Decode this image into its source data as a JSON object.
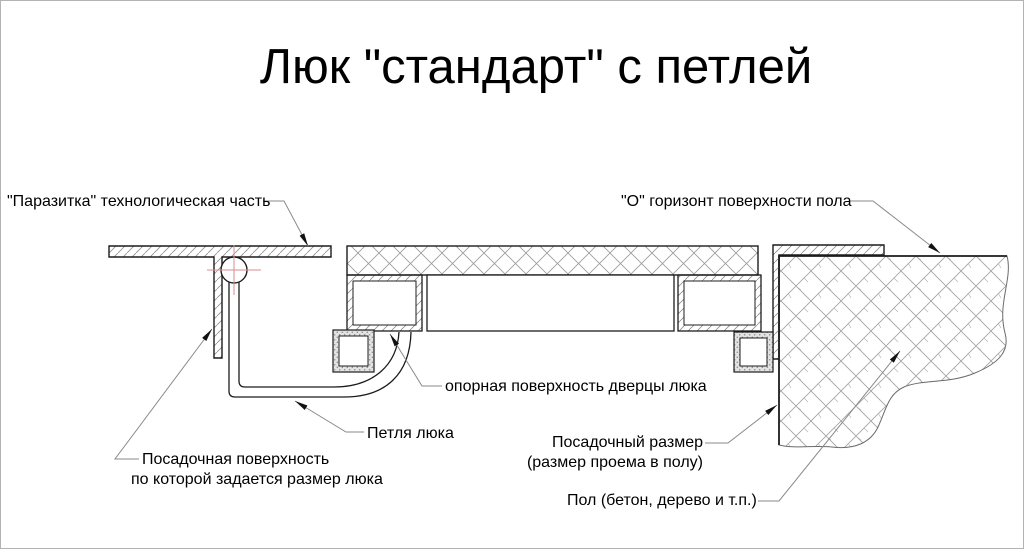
{
  "title": "Люк \"стандарт\" с петлей",
  "labels": {
    "parasitka": "\"Паразитка\" технологическая часть",
    "horizon": "\"О\" горизонт поверхности пола",
    "support_surface": "опорная поверхность дверцы люка",
    "hinge": "Петля люка",
    "seating_surface_line1": "Посадочная поверхность",
    "seating_surface_line2": "по которой задается размер люка",
    "seating_size_line1": "Посадочный размер",
    "seating_size_line2": "(размер проема в полу)",
    "floor": "Пол (бетон, дерево и т.п.)"
  },
  "colors": {
    "background": "#ffffff",
    "outline": "#1c1c1c",
    "hatch": "#9a9a9a",
    "leader": "#8a8a8a",
    "center_mark": "#d58d8d",
    "border": "#b3b3b3"
  }
}
